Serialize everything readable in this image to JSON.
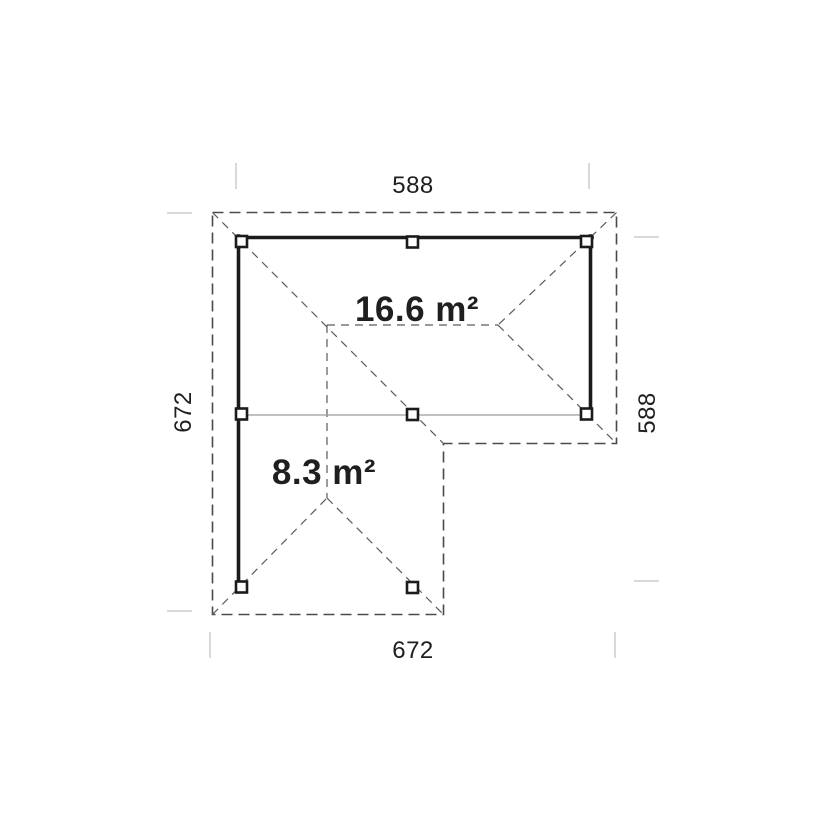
{
  "plan": {
    "dimensions": {
      "top": "588",
      "right": "588",
      "bottom": "672",
      "left": "672"
    },
    "areas": {
      "main": "16.6 m²",
      "annex": "8.3 m²"
    },
    "colors": {
      "wall": "#1b1b1b",
      "roof_dash": "#4a4a4a",
      "inner_dash": "#5a5a5a",
      "beam": "#9c9c9c",
      "tick": "#d9d9d9",
      "text": "#1f1f1f",
      "background": "#ffffff"
    }
  }
}
